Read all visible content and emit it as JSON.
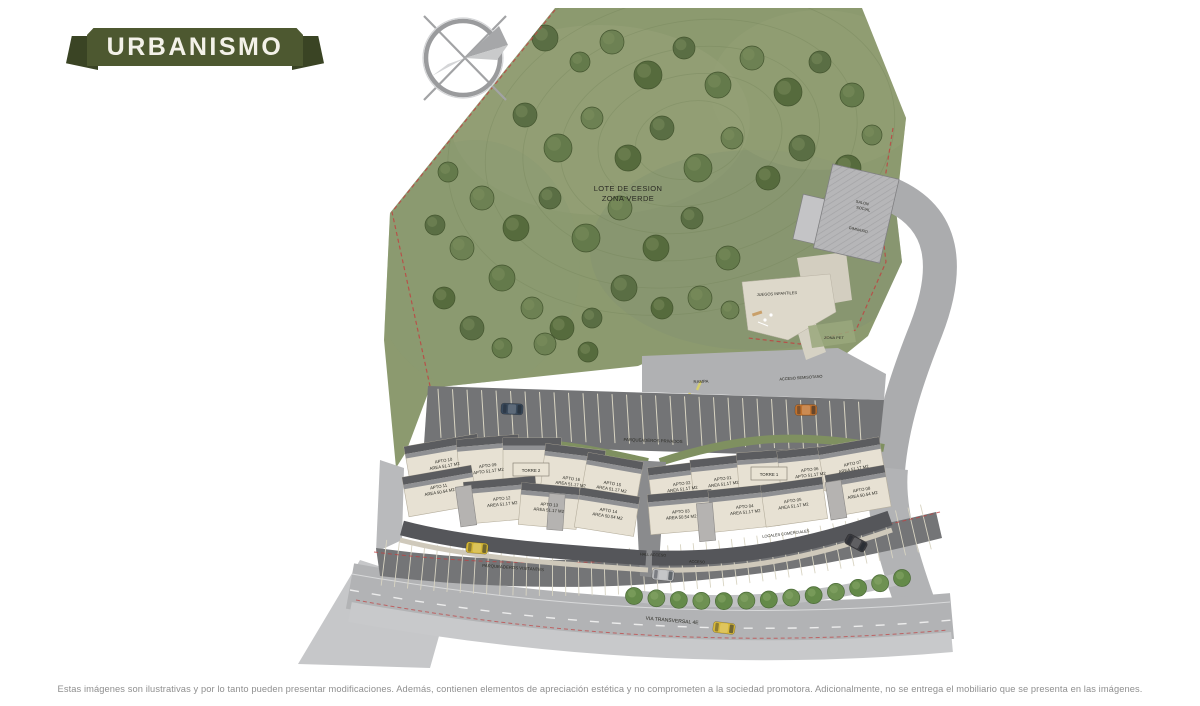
{
  "page": {
    "badge_label": "URBANISMO",
    "disclaimer": "Estas imágenes son ilustrativas y por lo tanto pueden presentar modificaciones. Además, contienen elementos de apreciación estética y no comprometen a la sociedad promotora. Adicionalmente, no se entrega el mobiliario que se presenta en las imágenes."
  },
  "colors": {
    "ribbon": "#4d5830",
    "ribbon_dark": "#3a4424",
    "grass": "#8c9a6f",
    "tree": "#5a6e44",
    "road": "#abacae",
    "parking": "#737476",
    "building": "#e7e1d3",
    "roof_dark": "#5b5c5f",
    "boundary_red": "#c04040",
    "disclaimer_text": "#8f8f8f"
  },
  "plan": {
    "green_zone_label": [
      "LOTE DE CESION",
      "ZONA VERDE"
    ],
    "labels": {
      "salon_1": "SALON",
      "salon_2": "SOCIAL",
      "gimnasio": "GIMNASIO",
      "juegos_infantiles": "JUEGOS INFANTILES",
      "zona_pet": "ZONA PET",
      "rampa": "RAMPA",
      "acceso_semisotano": "ACCESO SEMISOTANO",
      "parqueaderos_privados": "PARQUEADEROS PRIVADOS",
      "parqueaderos_visitantes": "PARQUEADEROS VISITANTES",
      "locales_comerciales": "LOCALES COMERCIALES",
      "hall_acceso": "HALL ACCESO",
      "acceso": "ACCESO",
      "via_transversal": "VIA TRANSVERSAL 4E",
      "torre_1": "TORRE 1",
      "torre_2": "TORRE 2"
    },
    "apartments": [
      {
        "id": "APTO 10",
        "area": "AREA 51.17 M2"
      },
      {
        "id": "APTO 09",
        "area": "APTO 51.17 M2"
      },
      {
        "id": "APTO 16",
        "area": "AREA 51.17 M2"
      },
      {
        "id": "APTO 15",
        "area": "AREA 51.17 M2"
      },
      {
        "id": "APTO 11",
        "area": "AREA 50.54 M2"
      },
      {
        "id": "APTO 12",
        "area": "AREA 51.17 M2"
      },
      {
        "id": "APTO 13",
        "area": "AREA 51.17 M2"
      },
      {
        "id": "APTO 14",
        "area": "AREA 50.54 M2"
      },
      {
        "id": "APTO 02",
        "area": "AREA 51.17 M2"
      },
      {
        "id": "APTO 01",
        "area": "AREA 51.17 M2"
      },
      {
        "id": "APTO 06",
        "area": "APTO 51.17 M2"
      },
      {
        "id": "APTO 07",
        "area": "AREA 51.17 M2"
      },
      {
        "id": "APTO 03",
        "area": "AREA 50.54 M2"
      },
      {
        "id": "APTO 04",
        "area": "AREA 51.17 M2"
      },
      {
        "id": "APTO 05",
        "area": "AREA 51.17 M2"
      },
      {
        "id": "APTO 08",
        "area": "AREA 50.54 M2"
      }
    ]
  }
}
